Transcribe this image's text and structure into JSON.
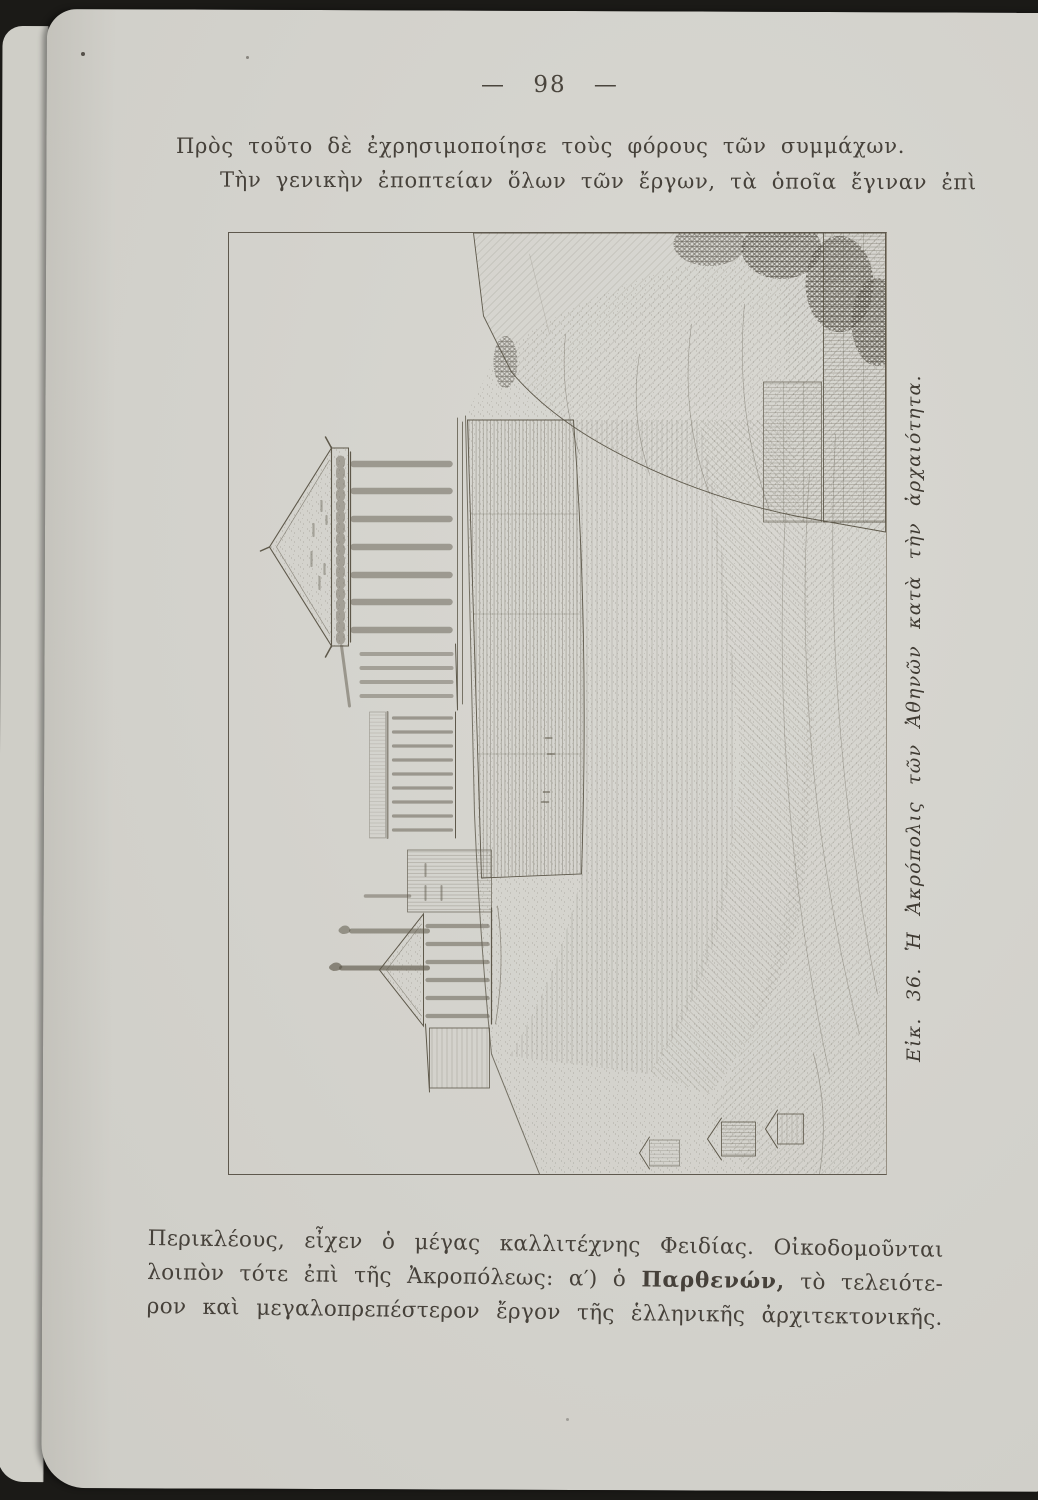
{
  "page": {
    "number": "— 98 —",
    "intro": {
      "line1": "Πρὸς τοῦτο δὲ ἐχρησιμοποίησε τοὺς φόρους τῶν συμμάχων.",
      "line2": "Τὴν γενικὴν ἐποπτείαν ὅλων τῶν ἔργων, τὰ ὁποῖα ἔγιναν ἐπὶ"
    },
    "figure": {
      "caption": "Εἰκ. 36. Ἡ Ἀκρόπολις τῶν Ἀθηνῶν κατὰ τὴν ἀρχαιότητα."
    },
    "body": {
      "line1": "Περικλέους, εἶχεν ὁ μέγας καλλιτέχνης Φειδίας. Οἰκοδομοῦνται",
      "line2_pre": "λοιπὸν τότε ἐπὶ τῆς Ἀκροπόλεως: α′) ὁ ",
      "line2_bold": "Παρθενών,",
      "line2_post": " τὸ τελειότε-",
      "line3": "ρον καὶ μεγαλοπρεπέστερον ἔργον τῆς ἑλληνικῆς ἀρχιτεκτονικῆς."
    },
    "colors": {
      "paper": "#d6d5cf",
      "ink": "#433e36",
      "scan_background": "#1b1a17"
    }
  }
}
